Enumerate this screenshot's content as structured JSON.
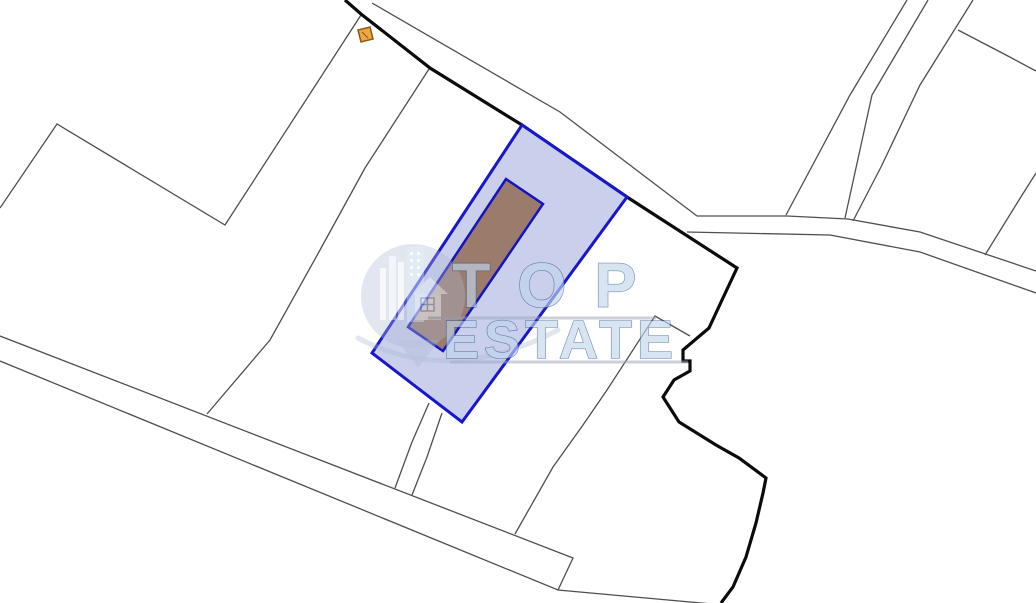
{
  "watermark": {
    "brand_line1": "TOP",
    "brand_line2": "ESTATE",
    "text_fill": "#c2d6ec",
    "text_stroke": "#33568e",
    "underline_color": "#9aa7bb",
    "logo_circle_color": "#aebad2",
    "opacity": 0.65
  },
  "map": {
    "background": "#ffffff",
    "colors": {
      "thin_line": "#4f4f4f",
      "thick_line": "#0b0b0b",
      "parcel_fill": "#cacfec",
      "parcel_stroke": "#1717cd",
      "building_fill": "#9a7b6c",
      "building_stroke": "#1515c0",
      "small_building_fill": "#eca648",
      "small_building_stroke": "#8a5a12"
    },
    "thin_lines": [
      {
        "name": "boundary-west-peak",
        "points": "0,208 57,124 225,225 361,15"
      },
      {
        "name": "boundary-center-long",
        "points": "429,69 365,168 320,250 270,340 207,414"
      },
      {
        "name": "road-south-upper-edge",
        "points": "0,336 573,558 558,590"
      },
      {
        "name": "road-south-lower-edge",
        "points": "0,361 558,590 712,604"
      },
      {
        "name": "lane-left-edge",
        "points": "429,403 412,442 395,488"
      },
      {
        "name": "lane-right-edge",
        "points": "442,413 427,457 412,495"
      },
      {
        "name": "boundary-diagonal-southeast",
        "points": "690,336 655,316 607,390 583,425 553,467 515,534"
      },
      {
        "name": "road-main-upper-edge",
        "points": "372,3 560,112 697,216"
      },
      {
        "name": "path-east-upper-edge",
        "points": "697,216 787,216 848,219 920,232 1036,271"
      },
      {
        "name": "path-east-lower-edge",
        "points": "687,232 830,235 920,252 1036,293"
      },
      {
        "name": "road-northeast-left-edge",
        "points": "907,0 850,95 786,215"
      },
      {
        "name": "road-northeast-right-edge",
        "points": "928,0 872,95 845,218"
      },
      {
        "name": "boundary-northeast-parallel",
        "points": "973,0 920,85 881,167 853,221"
      },
      {
        "name": "boundary-east-branch",
        "points": "958,30 1006,55 1036,71"
      },
      {
        "name": "boundary-far-east",
        "points": "1036,173 1019,200 985,255"
      }
    ],
    "thick_line": {
      "name": "boundary-main-thick",
      "points": "345,0 361,14 430,68 522,125 627,197 737,268 722,300 709,328 683,350 683,361 690,361 690,371 674,380 663,397 679,422 716,445 739,458 766,478 763,493 756,523 746,557 733,587 721,603"
    },
    "highlight_parcel": {
      "name": "highlighted-parcel",
      "points": "522,125 627,197 462,422 372,353"
    },
    "building": {
      "name": "building-footprint",
      "points": "506,179 543,204 443,351 408,327"
    },
    "small_building": {
      "name": "small-outbuilding",
      "points": "358,30 370,27 373,39 361,42",
      "roof_line": "362,32 368,38"
    }
  }
}
